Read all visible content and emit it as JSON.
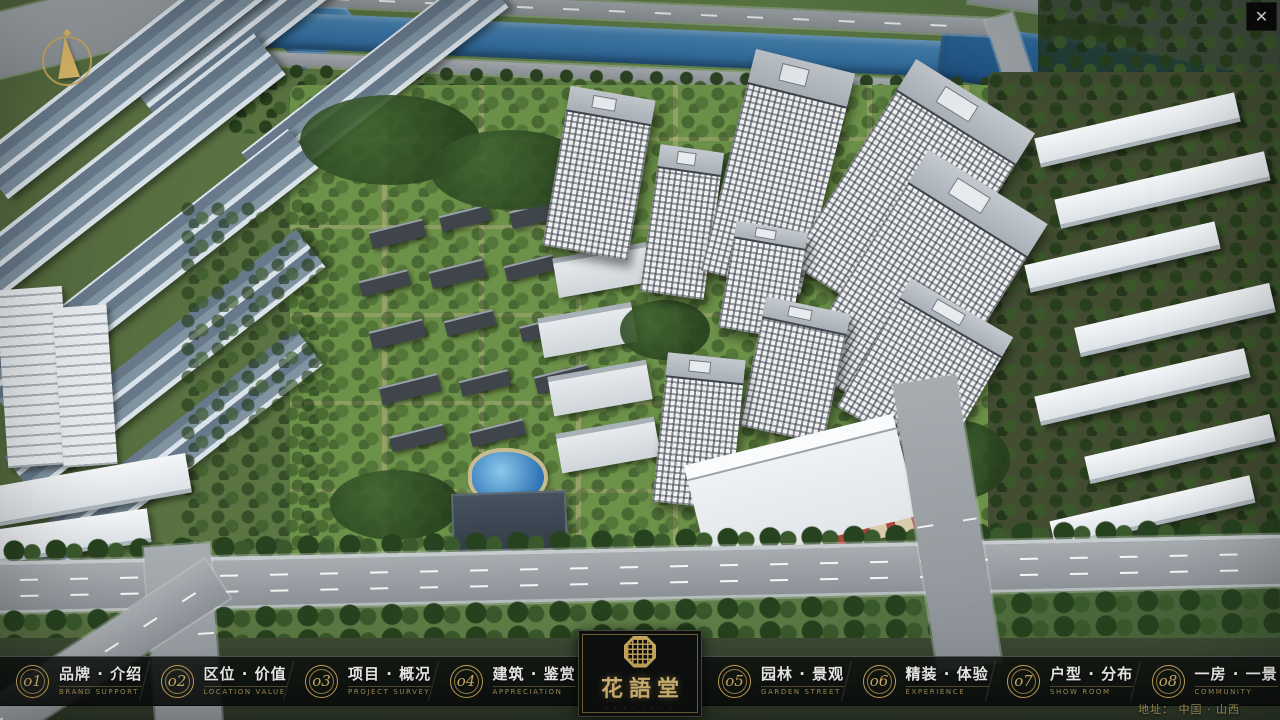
{
  "window": {
    "close_icon": "✕"
  },
  "brand": {
    "name": "花語堂",
    "subtext": "· · · · · · · ·"
  },
  "menu": {
    "items": [
      {
        "num": "o1",
        "label": "品牌 · 介绍",
        "sub": "BRAND SUPPORT"
      },
      {
        "num": "o2",
        "label": "区位 · 价值",
        "sub": "LOCATION VALUE"
      },
      {
        "num": "o3",
        "label": "项目 · 概况",
        "sub": "PROJECT SURVEY"
      },
      {
        "num": "o4",
        "label": "建筑 · 鉴赏",
        "sub": "APPRECIATION"
      },
      {
        "num": "o5",
        "label": "园林 · 景观",
        "sub": "GARDEN STREET"
      },
      {
        "num": "o6",
        "label": "精装 · 体验",
        "sub": "EXPERIENCE"
      },
      {
        "num": "o7",
        "label": "户型 · 分布",
        "sub": "SHOW ROOM"
      },
      {
        "num": "o8",
        "label": "一房 · 一景",
        "sub": "COMMUNITY"
      }
    ]
  },
  "footer": {
    "address": "地址：  中国 · 山西"
  },
  "colors": {
    "accent_gold": "#c9a85c",
    "bar_background": "rgba(14,18,15,0.88)",
    "river_blue": "#2b6495",
    "label_white": "#f4f4f2",
    "subtitle_gold": "#a8935c"
  }
}
